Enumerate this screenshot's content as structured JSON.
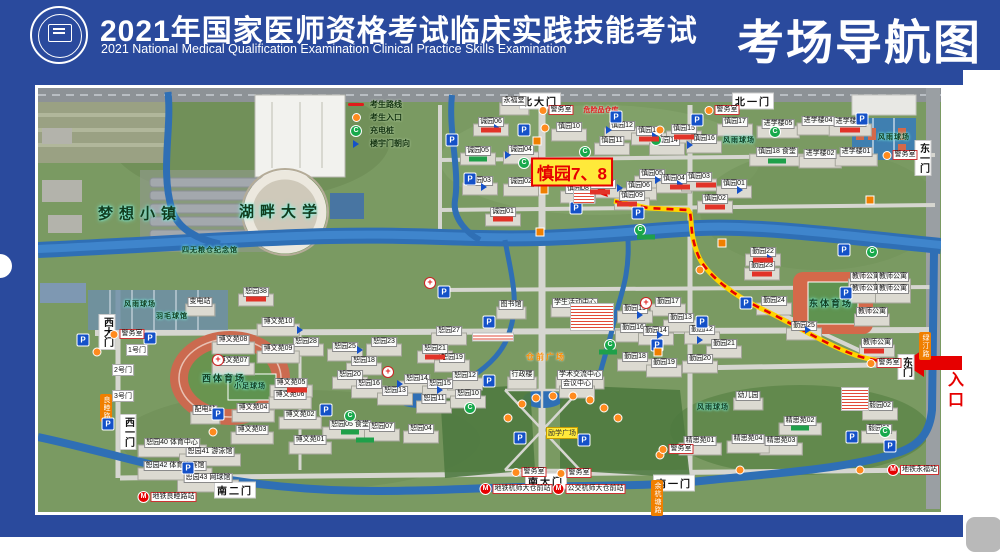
{
  "header": {
    "title_cn": "2021年国家医师资格考试临床实践技能考试",
    "title_en": "2021 National Medical Qualification Examination Clinical Practice Skills Examination",
    "title_right": "考场导航图"
  },
  "legend": {
    "items": [
      {
        "icon": "route-line",
        "label": "考生路线"
      },
      {
        "icon": "entry-dot",
        "label": "考生入口"
      },
      {
        "icon": "charging",
        "label": "充电桩"
      },
      {
        "icon": "door-flag",
        "label": "楼宇门朝向"
      }
    ]
  },
  "map": {
    "highlight": {
      "text": "慎园7、8",
      "x": 572,
      "y": 172
    },
    "entrance": {
      "text": "入口",
      "x": 953,
      "y": 391
    },
    "police_label": "警务室",
    "labels": [
      [
        540,
        101,
        "北大门",
        "g"
      ],
      [
        753,
        101,
        "北一门",
        "g"
      ],
      [
        923,
        158,
        "东一门",
        "gv"
      ],
      [
        906,
        367,
        "东门",
        "gv"
      ],
      [
        546,
        481,
        "南大门",
        "g"
      ],
      [
        674,
        483,
        "南一门",
        "g"
      ],
      [
        235,
        490,
        "南二门",
        "g"
      ],
      [
        107,
        332,
        "西大门",
        "gv"
      ],
      [
        128,
        432,
        "西一门",
        "gv"
      ],
      [
        137,
        350,
        "1号门",
        "gs"
      ],
      [
        123,
        370,
        "2号门",
        "gs"
      ],
      [
        123,
        396,
        "3号门",
        "gs"
      ],
      [
        140,
        213,
        "梦想小镇",
        "a"
      ],
      [
        281,
        211,
        "湖畔大学",
        "a"
      ],
      [
        210,
        250,
        "四无粮仓纪念馆",
        "ax"
      ],
      [
        224,
        378,
        "西体育场",
        "as"
      ],
      [
        831,
        303,
        "东体育场",
        "as"
      ],
      [
        250,
        386,
        "小足球场",
        "ax"
      ],
      [
        140,
        304,
        "风雨球场",
        "ax"
      ],
      [
        739,
        140,
        "风雨球场",
        "ax"
      ],
      [
        894,
        137,
        "风雨球场",
        "ax"
      ],
      [
        713,
        407,
        "风雨球场",
        "ax"
      ],
      [
        172,
        316,
        "羽毛球馆",
        "ax"
      ],
      [
        514,
        101,
        "永福堂",
        "b"
      ],
      [
        511,
        305,
        "图书馆",
        "b"
      ],
      [
        575,
        303,
        "学生活动中心",
        "b"
      ],
      [
        522,
        375,
        "行政楼",
        "b"
      ],
      [
        580,
        375,
        "学术交流中心",
        "b"
      ],
      [
        577,
        384,
        "会议中心",
        "b"
      ],
      [
        200,
        302,
        "变电站",
        "b"
      ],
      [
        205,
        410,
        "配电站",
        "b"
      ],
      [
        172,
        443,
        "恕园40 体育中心",
        "b"
      ],
      [
        210,
        452,
        "恕园41 游泳馆",
        "b"
      ],
      [
        175,
        466,
        "恕园42 体育比赛馆",
        "b"
      ],
      [
        208,
        478,
        "恕园43 网球馆",
        "b"
      ],
      [
        748,
        396,
        "幼儿园",
        "b"
      ],
      [
        256,
        292,
        "恕园38",
        "b"
      ],
      [
        601,
        110,
        "危险品仓库",
        "rt"
      ],
      [
        546,
        357,
        "仓前广场",
        "ot"
      ],
      [
        562,
        433,
        "励学广场",
        "yt"
      ],
      [
        925,
        346,
        "绿汀路",
        "road"
      ],
      [
        106,
        408,
        "良睦路",
        "road"
      ],
      [
        657,
        498,
        "余杭塘路",
        "road"
      ],
      [
        569,
        127,
        "慎园10",
        "b"
      ],
      [
        622,
        126,
        "慎园12",
        "b"
      ],
      [
        649,
        131,
        "慎园13",
        "b"
      ],
      [
        684,
        129,
        "慎园15",
        "b"
      ],
      [
        612,
        141,
        "慎园11",
        "b"
      ],
      [
        667,
        141,
        "慎园14",
        "b"
      ],
      [
        704,
        139,
        "慎园16",
        "b"
      ],
      [
        735,
        122,
        "慎园17",
        "b"
      ],
      [
        652,
        174,
        "慎园05",
        "b"
      ],
      [
        674,
        179,
        "慎园04",
        "b"
      ],
      [
        699,
        177,
        "慎园03",
        "b"
      ],
      [
        734,
        184,
        "慎园01",
        "b"
      ],
      [
        715,
        199,
        "慎园02",
        "b"
      ],
      [
        639,
        186,
        "慎园06",
        "b"
      ],
      [
        603,
        184,
        "慎园07",
        "b"
      ],
      [
        578,
        189,
        "慎园08",
        "b"
      ],
      [
        632,
        196,
        "慎园09",
        "b"
      ],
      [
        777,
        152,
        "慎园18 食堂",
        "b"
      ],
      [
        491,
        122,
        "诚园06",
        "b"
      ],
      [
        478,
        151,
        "诚园05",
        "b"
      ],
      [
        521,
        150,
        "诚园04",
        "b"
      ],
      [
        480,
        181,
        "诚园03",
        "b"
      ],
      [
        521,
        182,
        "诚园02",
        "b"
      ],
      [
        503,
        212,
        "诚园01",
        "b"
      ],
      [
        778,
        124,
        "进学楼05",
        "b"
      ],
      [
        818,
        121,
        "进学楼04",
        "b"
      ],
      [
        850,
        122,
        "进学楼03",
        "b"
      ],
      [
        820,
        154,
        "进学楼02",
        "b"
      ],
      [
        856,
        152,
        "进学楼01",
        "b"
      ],
      [
        668,
        302,
        "勤园17",
        "b"
      ],
      [
        635,
        309,
        "勤园15",
        "b"
      ],
      [
        633,
        328,
        "勤园16",
        "b"
      ],
      [
        656,
        331,
        "勤园14",
        "b"
      ],
      [
        681,
        318,
        "勤园13",
        "b"
      ],
      [
        702,
        330,
        "勤园12",
        "b"
      ],
      [
        635,
        357,
        "勤园18",
        "b"
      ],
      [
        664,
        363,
        "勤园19",
        "b"
      ],
      [
        700,
        359,
        "勤园20",
        "b"
      ],
      [
        724,
        344,
        "勤园21",
        "b"
      ],
      [
        763,
        252,
        "勤园22",
        "b"
      ],
      [
        762,
        266,
        "勤园23",
        "b"
      ],
      [
        774,
        301,
        "勤园24",
        "b"
      ],
      [
        804,
        326,
        "勤园25",
        "b"
      ],
      [
        306,
        342,
        "恕园28",
        "b"
      ],
      [
        345,
        347,
        "恕园25",
        "b"
      ],
      [
        384,
        342,
        "恕园23",
        "b"
      ],
      [
        435,
        349,
        "恕园21",
        "b"
      ],
      [
        449,
        331,
        "恕园27",
        "b"
      ],
      [
        364,
        361,
        "恕园18",
        "b"
      ],
      [
        350,
        375,
        "恕园20",
        "b"
      ],
      [
        369,
        384,
        "恕园16",
        "b"
      ],
      [
        417,
        379,
        "恕园14",
        "b"
      ],
      [
        440,
        384,
        "恕园15",
        "b"
      ],
      [
        465,
        376,
        "恕园12",
        "b"
      ],
      [
        395,
        391,
        "恕园13",
        "b"
      ],
      [
        434,
        399,
        "恕园11",
        "b"
      ],
      [
        468,
        394,
        "恕园10",
        "b"
      ],
      [
        452,
        358,
        "恕园19",
        "b"
      ],
      [
        350,
        425,
        "恕园05 食堂",
        "b"
      ],
      [
        382,
        427,
        "恕园07",
        "b"
      ],
      [
        421,
        429,
        "恕园04",
        "b"
      ],
      [
        278,
        322,
        "博文苑10",
        "b"
      ],
      [
        233,
        340,
        "博文苑08",
        "b"
      ],
      [
        278,
        349,
        "博文苑09",
        "b"
      ],
      [
        233,
        361,
        "博文苑07",
        "b"
      ],
      [
        291,
        383,
        "博文苑05",
        "b"
      ],
      [
        290,
        395,
        "博文苑06",
        "b"
      ],
      [
        253,
        408,
        "博文苑04",
        "b"
      ],
      [
        300,
        415,
        "博文苑02",
        "b"
      ],
      [
        252,
        430,
        "博文苑03",
        "b"
      ],
      [
        310,
        440,
        "博文苑01",
        "b"
      ],
      [
        866,
        277,
        "教师公寓",
        "b"
      ],
      [
        893,
        277,
        "教师公寓",
        "b"
      ],
      [
        866,
        289,
        "教师公寓",
        "b"
      ],
      [
        893,
        289,
        "教师公寓",
        "b"
      ],
      [
        872,
        312,
        "教师公寓",
        "b"
      ],
      [
        877,
        343,
        "教师公寓",
        "b"
      ],
      [
        700,
        441,
        "精思苑01",
        "b"
      ],
      [
        800,
        421,
        "精思苑02",
        "b"
      ],
      [
        781,
        441,
        "精思苑03",
        "b"
      ],
      [
        748,
        439,
        "精思苑04",
        "b"
      ],
      [
        880,
        406,
        "毅园02",
        "b"
      ],
      [
        879,
        429,
        "毅园01",
        "b"
      ]
    ],
    "police": [
      [
        556,
        110
      ],
      [
        722,
        110
      ],
      [
        900,
        155
      ],
      [
        127,
        334
      ],
      [
        884,
        363
      ],
      [
        529,
        472
      ],
      [
        574,
        473
      ],
      [
        676,
        449
      ]
    ],
    "metro": [
      [
        167,
        497,
        "地铁良睦路站"
      ],
      [
        516,
        489,
        "地铁杭师大仓前站"
      ],
      [
        589,
        489,
        "公交杭师大仓前站"
      ],
      [
        913,
        470,
        "地铁永福站"
      ]
    ],
    "parking": [
      [
        452,
        140
      ],
      [
        524,
        130
      ],
      [
        470,
        179
      ],
      [
        576,
        208
      ],
      [
        638,
        213
      ],
      [
        616,
        117
      ],
      [
        697,
        120
      ],
      [
        862,
        119
      ],
      [
        83,
        340
      ],
      [
        150,
        338
      ],
      [
        218,
        414
      ],
      [
        326,
        410
      ],
      [
        188,
        468
      ],
      [
        108,
        424
      ],
      [
        444,
        292
      ],
      [
        489,
        322
      ],
      [
        489,
        381
      ],
      [
        520,
        438
      ],
      [
        657,
        345
      ],
      [
        702,
        322
      ],
      [
        844,
        250
      ],
      [
        846,
        293
      ],
      [
        852,
        437
      ],
      [
        890,
        446
      ],
      [
        746,
        303
      ],
      [
        584,
        440
      ]
    ],
    "charging": [
      [
        585,
        152
      ],
      [
        640,
        230
      ],
      [
        350,
        416
      ],
      [
        610,
        345
      ],
      [
        885,
        432
      ],
      [
        656,
        140
      ],
      [
        470,
        408
      ],
      [
        775,
        132
      ],
      [
        524,
        163
      ],
      [
        872,
        252
      ]
    ],
    "medical": [
      [
        430,
        283
      ],
      [
        388,
        372
      ],
      [
        218,
        360
      ],
      [
        646,
        303
      ]
    ],
    "flags": [
      [
        497,
        128
      ],
      [
        609,
        130
      ],
      [
        655,
        136
      ],
      [
        690,
        145
      ],
      [
        620,
        188
      ],
      [
        584,
        193
      ],
      [
        658,
        180
      ],
      [
        680,
        184
      ],
      [
        740,
        190
      ],
      [
        508,
        155
      ],
      [
        484,
        187
      ],
      [
        360,
        350
      ],
      [
        400,
        384
      ],
      [
        440,
        390
      ],
      [
        300,
        330
      ],
      [
        640,
        315
      ],
      [
        660,
        335
      ],
      [
        700,
        340
      ],
      [
        770,
        258
      ],
      [
        808,
        330
      ]
    ],
    "dots": [
      [
        508,
        418
      ],
      [
        522,
        404
      ],
      [
        536,
        398
      ],
      [
        553,
        396
      ],
      [
        573,
        396
      ],
      [
        590,
        400
      ],
      [
        604,
        408
      ],
      [
        618,
        418
      ],
      [
        545,
        128
      ],
      [
        660,
        130
      ],
      [
        700,
        270
      ],
      [
        660,
        455
      ],
      [
        740,
        470
      ],
      [
        860,
        470
      ],
      [
        97,
        352
      ],
      [
        213,
        432
      ]
    ],
    "notices": [
      [
        592,
        317,
        42,
        26
      ],
      [
        855,
        399,
        26,
        22
      ],
      [
        584,
        197,
        20,
        12
      ],
      [
        493,
        337,
        40,
        7
      ]
    ],
    "red_tags": [
      [
        491,
        130
      ],
      [
        503,
        219
      ],
      [
        649,
        139
      ],
      [
        684,
        137
      ],
      [
        715,
        207
      ],
      [
        763,
        260
      ],
      [
        762,
        274
      ],
      [
        435,
        357
      ],
      [
        850,
        130
      ],
      [
        600,
        192
      ],
      [
        627,
        204
      ],
      [
        680,
        187
      ],
      [
        706,
        185
      ],
      [
        297,
        390
      ],
      [
        256,
        299
      ],
      [
        874,
        351
      ]
    ],
    "green_tags": [
      [
        478,
        159
      ],
      [
        777,
        161
      ],
      [
        350,
        432
      ],
      [
        800,
        428
      ],
      [
        608,
        352
      ],
      [
        646,
        237
      ],
      [
        365,
        440
      ]
    ],
    "diamonds": [
      [
        537,
        141
      ],
      [
        544,
        190
      ],
      [
        540,
        232
      ],
      [
        722,
        243
      ],
      [
        658,
        352
      ],
      [
        870,
        200
      ]
    ]
  }
}
